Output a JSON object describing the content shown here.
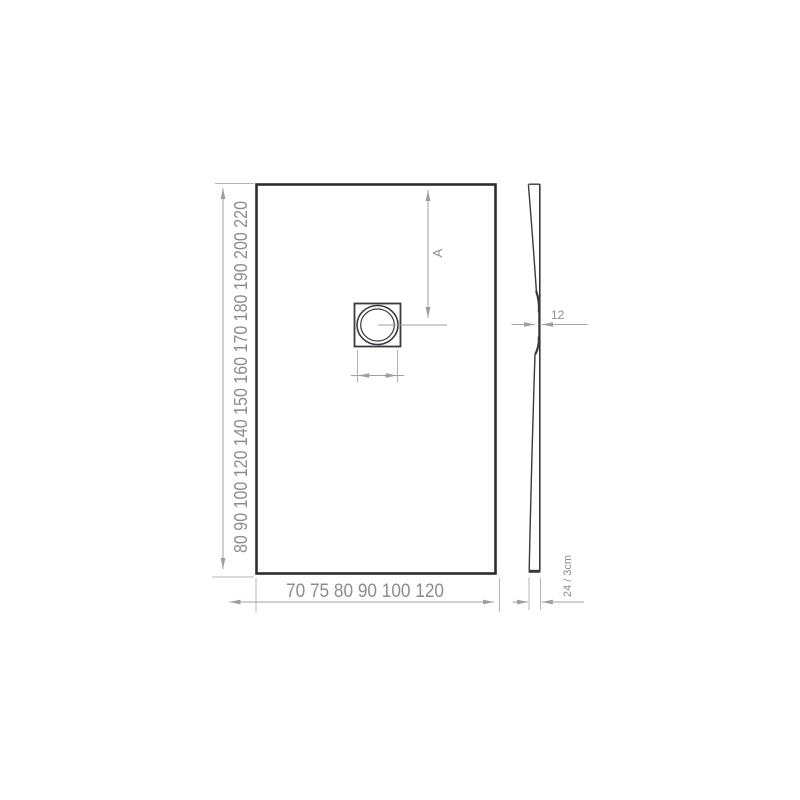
{
  "diagram": {
    "title": "shower-tray-technical-drawing",
    "plan": {
      "lengths_text": "80 90 100 120 140 150 160 170 180 190 200 220",
      "lengths": [
        80,
        90,
        100,
        120,
        140,
        150,
        160,
        170,
        180,
        190,
        200,
        220
      ],
      "widths_text": "70 75 80 90 100 120",
      "widths": [
        70,
        75,
        80,
        90,
        100,
        120
      ],
      "drain_offset_label": "A"
    },
    "profile": {
      "waist_thickness_label": "12",
      "edge_height_label": "24 / 3cm"
    },
    "colors": {
      "outline": "#2d2d31",
      "detail": "#3a3a3e",
      "dimension_line": "#a2a2a6",
      "label_gray": "#8c8c90",
      "label_dark": "#3c3c40",
      "background": "#ffffff"
    }
  }
}
